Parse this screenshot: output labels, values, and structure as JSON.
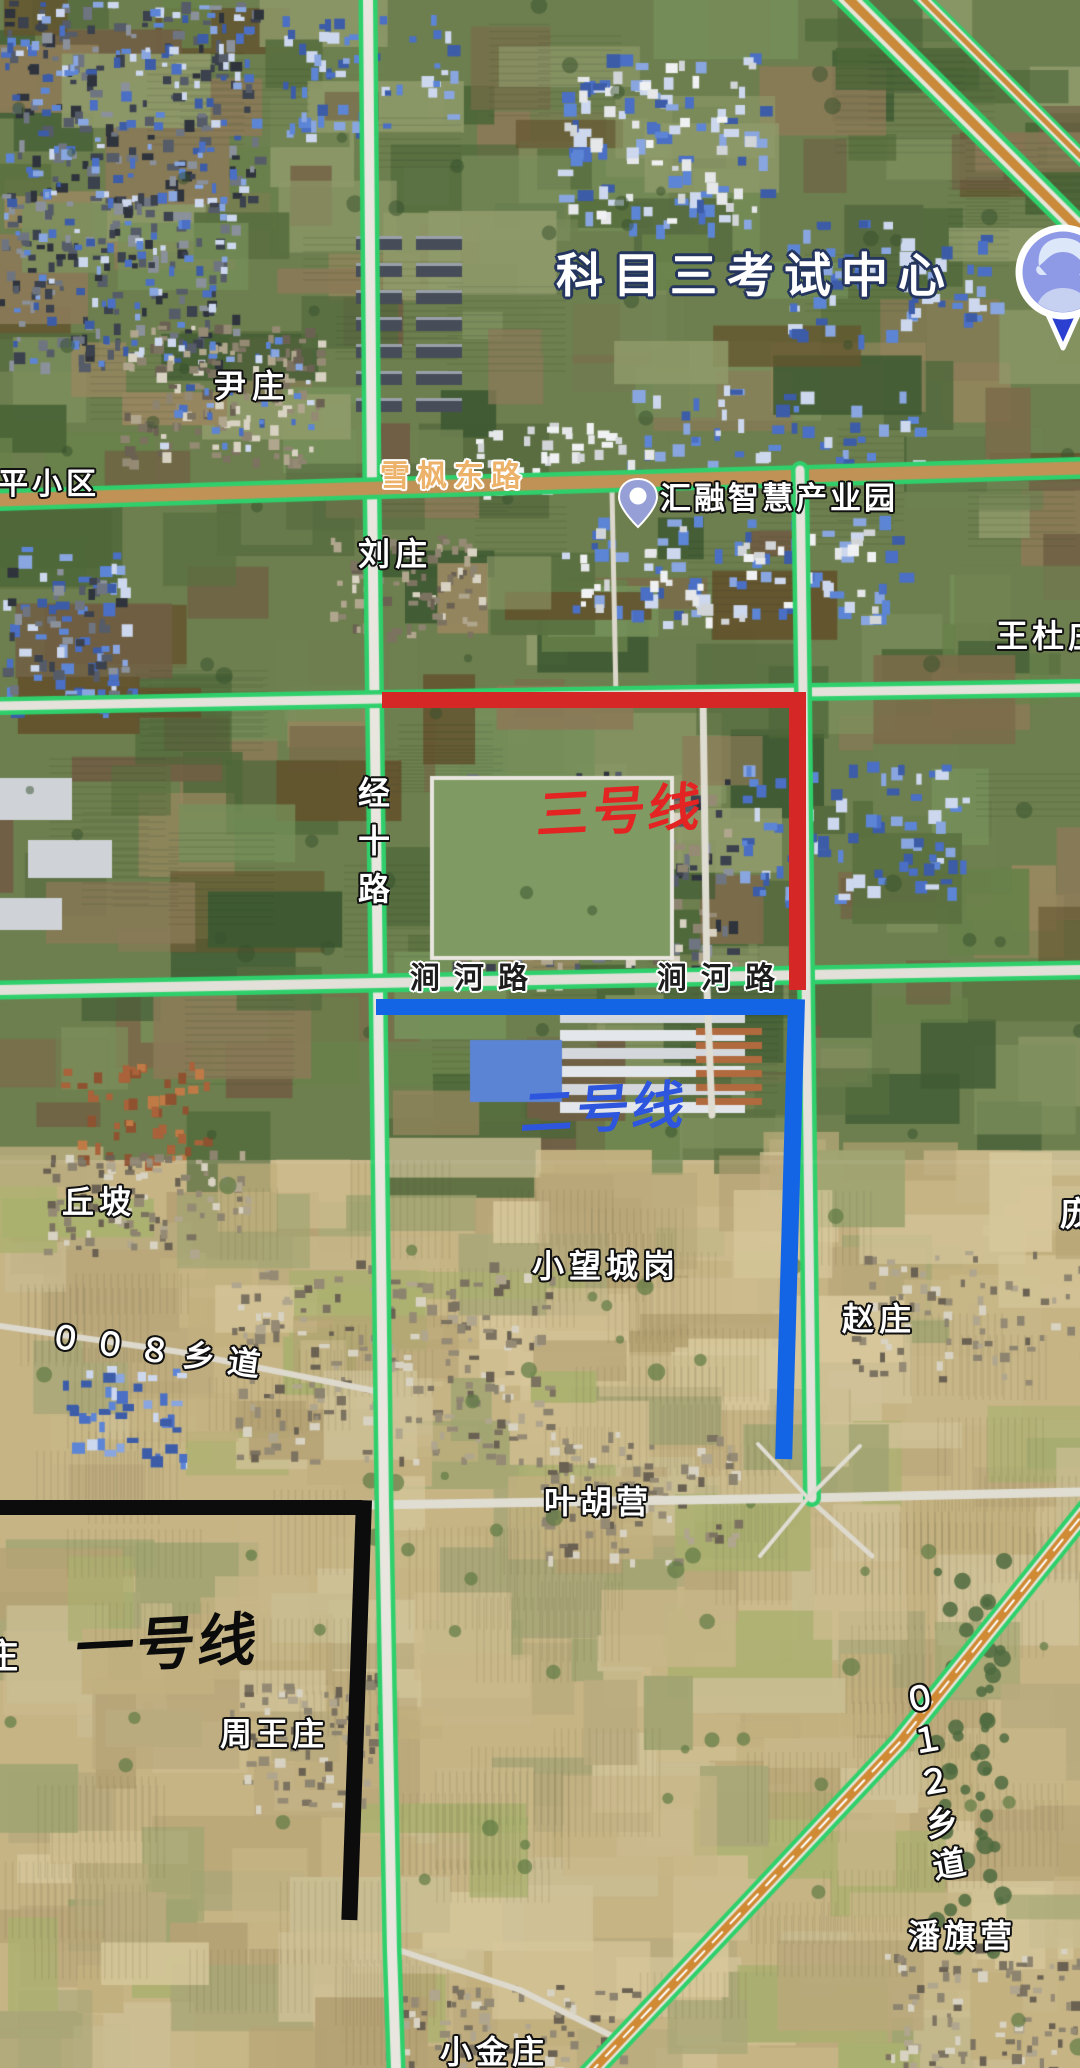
{
  "title": {
    "text": "科目三考试中心"
  },
  "routes": [
    {
      "id": "line1",
      "name": "一号线",
      "color": "#0c0c0c"
    },
    {
      "id": "line2",
      "name": "二号线",
      "color": "#1465e6"
    },
    {
      "id": "line3",
      "name": "三号线",
      "color": "#d42726"
    }
  ],
  "roads": {
    "xuefengdonglu": "雪枫东路",
    "jingshilu": "经十路",
    "jianhelu": "涧河路",
    "xiang008": "００８乡道",
    "xiang012": "０１２乡道"
  },
  "places": {
    "yinzhuang": "尹庄",
    "pingxiaoqu": "平小区",
    "liuzhuang": "刘庄",
    "wangduzhuang": "王杜庄",
    "qiupo": "丘坡",
    "pang_partial": "庞",
    "xiaowangchenggang": "小望城岗",
    "zhaozhuang": "赵庄",
    "yehuying": "叶胡营",
    "zhuang_partial": "庄",
    "zhouwangzhuang": "周王庄",
    "panqiying": "潘旗营",
    "xiaojinzhuang": "小金庄"
  },
  "poi": {
    "huirong": {
      "name": "汇融智慧产业园"
    }
  },
  "colors": {
    "road_highlight": "#2fd06c",
    "route_text_line2": "#2d55dd",
    "route_text_line3": "#e32422",
    "road_label_orange": "#ecb269",
    "title_outline": "#24355e"
  }
}
